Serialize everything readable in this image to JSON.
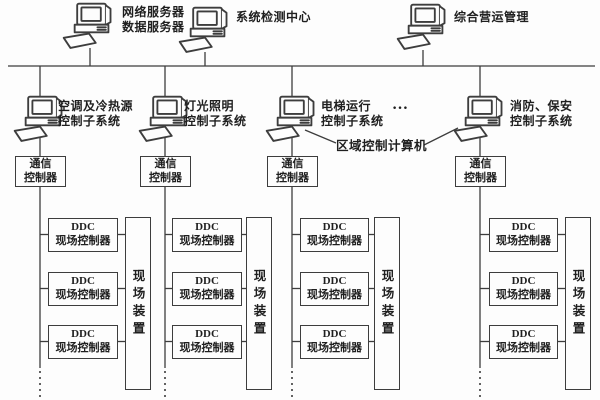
{
  "diagram": {
    "title_semantic": "building-automation-system-architecture",
    "top_computers": [
      {
        "label": "网络服务器\n数据服务器"
      },
      {
        "label": "系统检测中心"
      },
      {
        "label": "综合营运管理"
      }
    ],
    "subsystem_computers": [
      {
        "label": "空调及冷热源\n控制子系统"
      },
      {
        "label": "灯光照明\n控制子系统"
      },
      {
        "label": "电梯运行\n控制子系统"
      },
      {
        "label": "消防、保安\n控制子系统"
      }
    ],
    "more_subsystems_ellipsis": "…",
    "area_control_computer_label": "区域控制计算机",
    "comm_controller_label": "通信\n控制器",
    "ddc_controller_label": "DDC\n现场控制器",
    "field_device_label": "现场装置",
    "colors": {
      "line": "#3d3d3d",
      "background": "#fdfdfd",
      "text": "#1f1f1f"
    }
  }
}
